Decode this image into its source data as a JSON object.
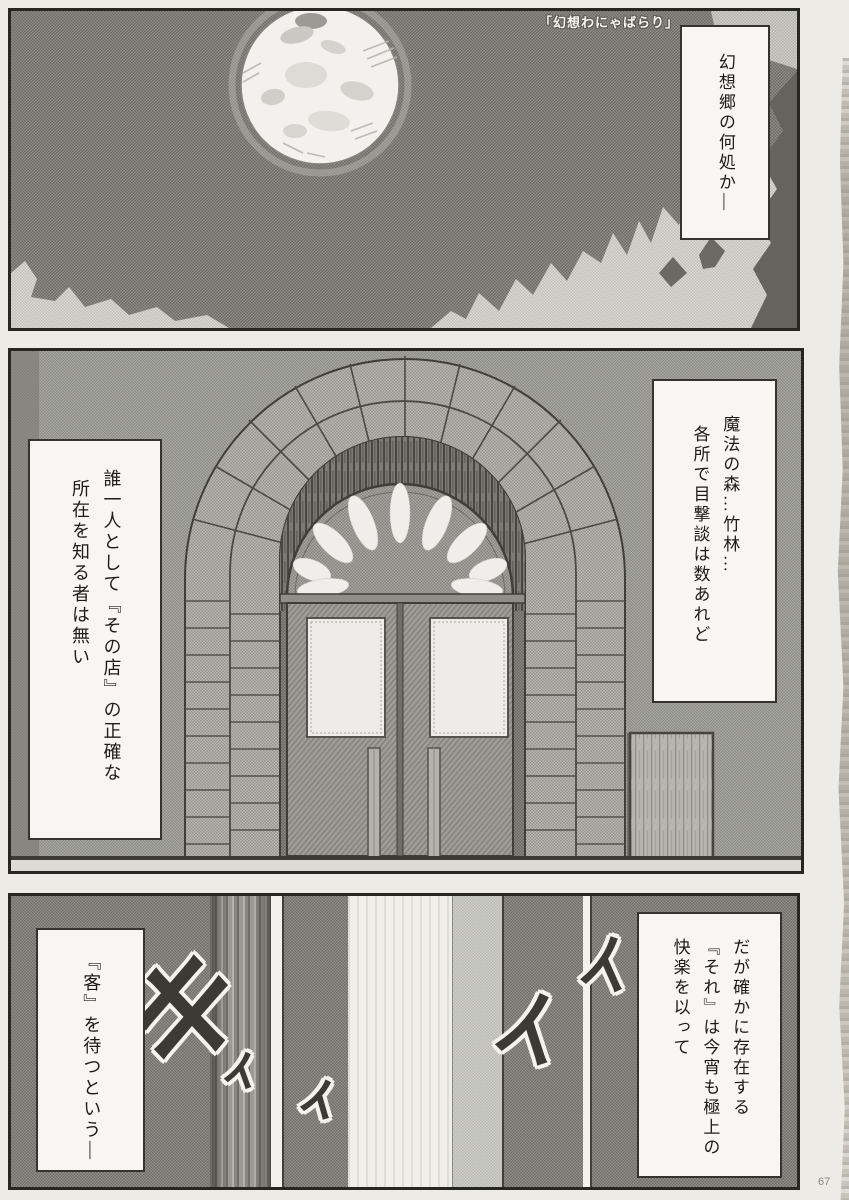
{
  "page": {
    "number": "67",
    "edge_caption": "「幻想わにゃばらり」"
  },
  "top_panel": {
    "narration": "幻想郷の何処か—"
  },
  "middle_panel": {
    "narration_right_l1": "魔法の森…竹林…",
    "narration_right_l2": "各所で目撃談は数あれど",
    "narration_left_l1": "誰一人として『その店』の正確な",
    "narration_left_l2": "所在を知る者は無い"
  },
  "bottom_panel": {
    "narration_right_l1": "だが確かに存在する",
    "narration_right_l2": "『それ』は今宵も極上の",
    "narration_right_l3": "快楽を以って",
    "narration_left": "『客』を待つという—",
    "sfx_ki": "キ",
    "sfx_i1": "ィ",
    "sfx_i2": "ィ",
    "sfx_i3": "イ",
    "sfx_i4": "イ"
  },
  "colors": {
    "paper": "#ecebe6",
    "ink": "#262622",
    "box_bg": "#f7f6f2"
  }
}
